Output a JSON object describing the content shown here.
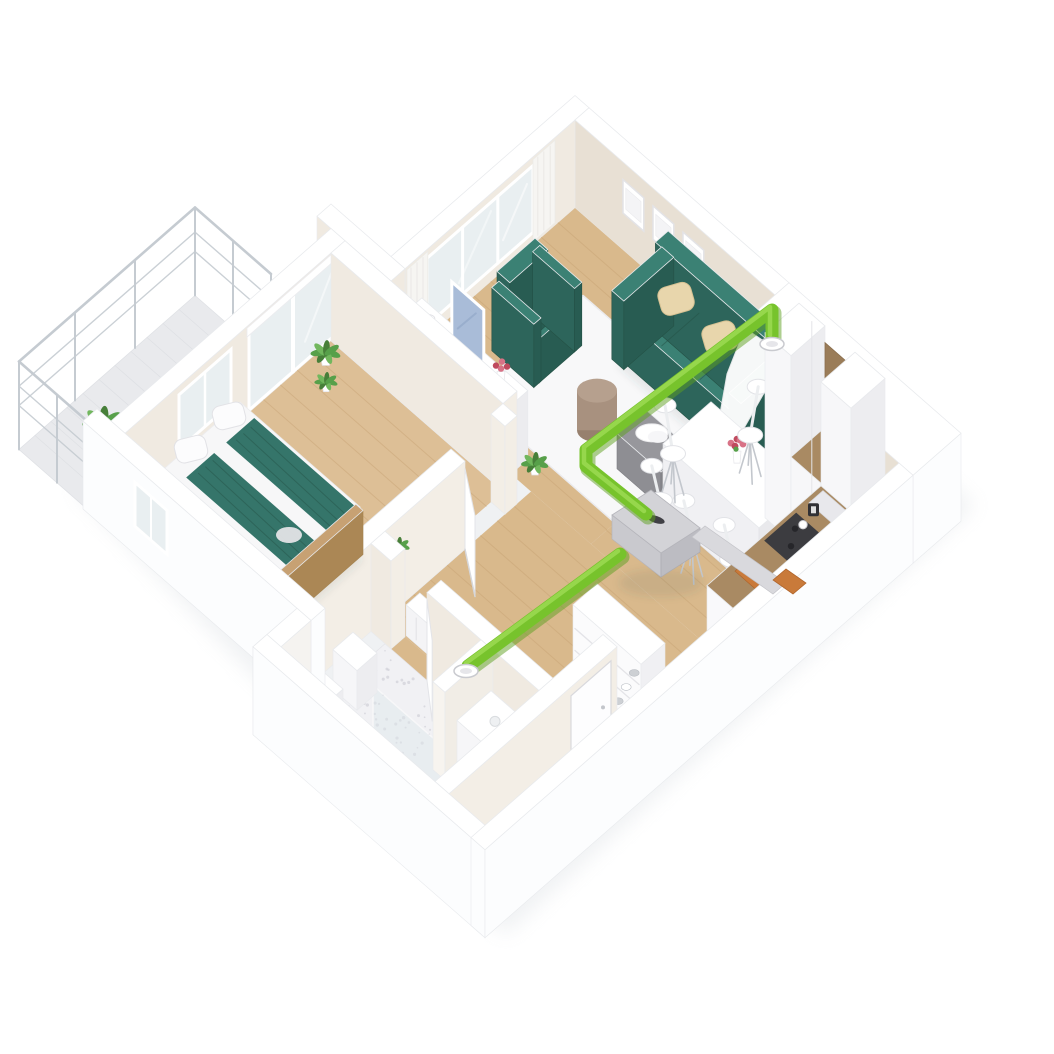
{
  "meta": {
    "canvas": {
      "w": 1054,
      "h": 1054
    },
    "background": "#ffffff"
  },
  "colors": {
    "wallTop": "#ffffff",
    "wallOuter": "#fcfdfe",
    "wallEdge": "#e8eaed",
    "wallInnerWarm": "#e8e0d4",
    "wallInnerWarmLight": "#f0eae1",
    "wallInnerSoft": "#f3eee6",
    "floorWood": "#d9b98c",
    "floorWoodBedroom": "#ddbf96",
    "plank": "#c09a6a",
    "floorTile": "#f1f1f4",
    "speckle": "#c6c6cf",
    "balconyFloor": "#e9eaed",
    "railing": "#c5cbd1",
    "rug": "#f8f8f9",
    "rugEdge": "#ebebee",
    "teal": "#35756a",
    "tealTop": "#3b8174",
    "tealFront": "#2d655b",
    "tealSide": "#285c52",
    "tealDark": "#245145",
    "pillowBeige": "#e8d6ac",
    "pillowBeigeDark": "#d6c192",
    "white": "#ffffff",
    "offWhite": "#f2f2f4",
    "pouf": "#a8917f",
    "poufTop": "#b6a08e",
    "poufDark": "#97806e",
    "tableGray": "#97979c",
    "tableGrayDark": "#86868b",
    "woodCounter": "#a98a63",
    "woodCounterDark": "#8b6f4e",
    "stove": "#3c3c40",
    "orange": "#c97a3a",
    "orangeDark": "#b0652c",
    "green": "#77c32c",
    "greenLight": "#9bdb52",
    "greenDark": "#5ea01f",
    "unitTop": "#d3d3d7",
    "unitSide": "#bcbcc2",
    "unitFace": "#c9c9ce",
    "duct": "#d9d9dd",
    "glass": "#e9eff1",
    "frameEdge": "#e3e3e6",
    "leaf": "#57a04a",
    "leafLight": "#71b75d",
    "leafDark": "#477f39",
    "flowerPink": "#d87286",
    "flowerRed": "#bf4a5e",
    "tvScreen": "#a9bcd8",
    "woodBed": "#c7a173",
    "potTan": "#d2a85f",
    "shadow": "#dde1e5"
  },
  "rooms": [
    {
      "name": "living-room",
      "floor": "wood",
      "furniture": [
        "sofa",
        "armchair",
        "rug",
        "pouf",
        "coffee-table",
        "tv-sideboard",
        "wall-frames"
      ]
    },
    {
      "name": "dining-area",
      "floor": "wood",
      "furniture": [
        "dining-table",
        "dining-chairs",
        "flower-vase"
      ]
    },
    {
      "name": "kitchen",
      "floor": "wood",
      "furniture": [
        "tall-cabinets",
        "counter",
        "cooktop",
        "coffee-machine",
        "cutting-board",
        "wall-pictures"
      ]
    },
    {
      "name": "hallway",
      "floor": "wood",
      "furniture": [
        "ventilation-unit",
        "shoe-rack",
        "radiator"
      ]
    },
    {
      "name": "bedroom",
      "floor": "wood",
      "furniture": [
        "double-bed",
        "bed-bench",
        "plants",
        "sliding-glass-door"
      ]
    },
    {
      "name": "bathroom",
      "floor": "tile",
      "furniture": [
        "shelves",
        "shower",
        "vanity",
        "plant"
      ]
    },
    {
      "name": "entrance",
      "floor": "wood",
      "furniture": [
        "entrance-door"
      ]
    },
    {
      "name": "balcony",
      "floor": "tile",
      "furniture": [
        "railing",
        "potted-plant"
      ]
    }
  ],
  "ventilation": {
    "duct_color_name": "green",
    "main_duct_path": [
      [
        772,
        338
      ],
      [
        772,
        310
      ],
      [
        586,
        450
      ],
      [
        586,
        466
      ],
      [
        646,
        514
      ]
    ],
    "branch_duct_path": [
      [
        620,
        554
      ],
      [
        468,
        666
      ]
    ],
    "supply_diffuser": [
      772,
      344
    ],
    "extract_diffuser": [
      466,
      671
    ],
    "unit_top": [
      [
        612,
        515
      ],
      [
        651,
        490
      ],
      [
        700,
        528
      ],
      [
        661,
        553
      ]
    ],
    "unit_depth": 24,
    "gray_duct": [
      [
        692,
        537
      ],
      [
        705,
        526
      ],
      [
        786,
        583
      ],
      [
        773,
        594
      ]
    ],
    "hood_cap": [
      [
        773,
        580
      ],
      [
        786,
        569
      ],
      [
        806,
        583
      ],
      [
        793,
        594
      ]
    ]
  }
}
